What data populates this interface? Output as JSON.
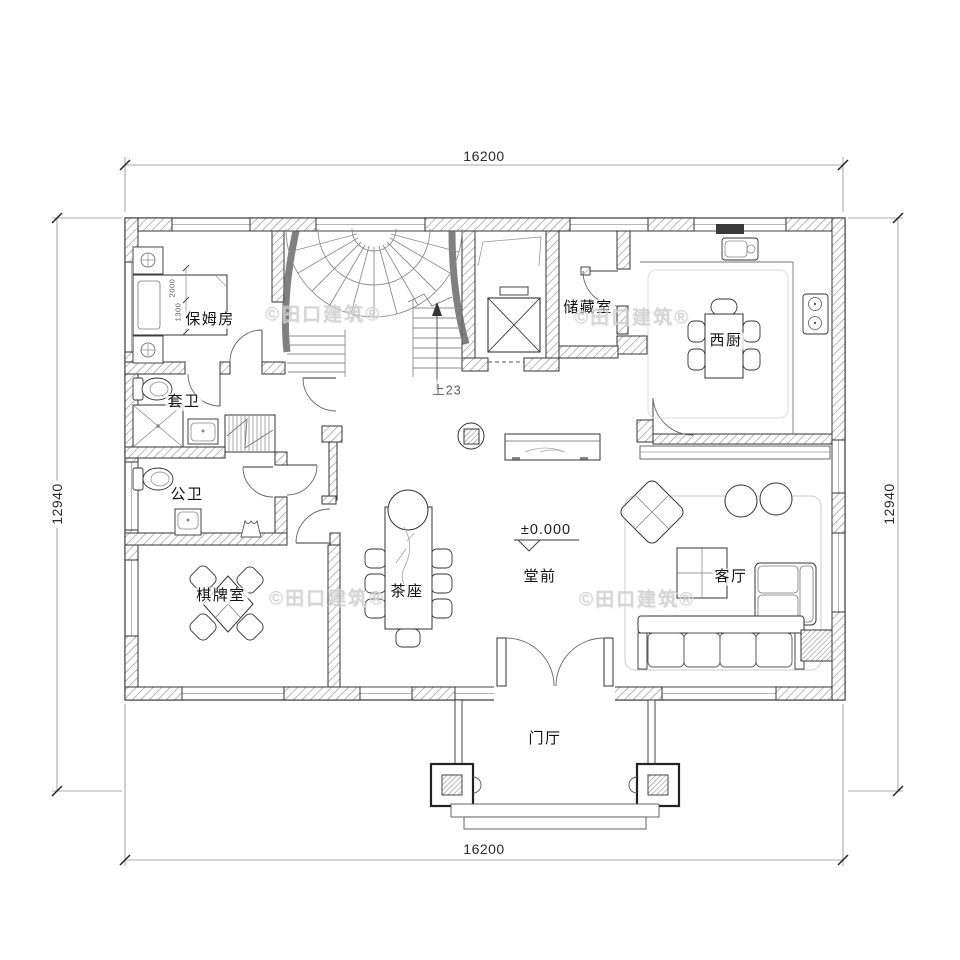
{
  "dims": {
    "top": "16200",
    "bottom": "16200",
    "left": "12940",
    "right": "12940"
  },
  "rooms": {
    "nanny": "保姆房",
    "ensuite": "套卫",
    "public_bath": "公卫",
    "chess": "棋牌室",
    "tea": "茶座",
    "front_hall": "堂前",
    "storage": "储藏室",
    "west_kitchen": "西厨",
    "living": "客厅",
    "foyer": "门厅"
  },
  "notes": {
    "elevation": "±0.000",
    "stair": "上23",
    "bed_w": "2000",
    "bed_d": "1300"
  },
  "watermark": "©田口建筑®",
  "colors": {
    "line": "#333333",
    "hatch": "#9a9a9a",
    "watermark": "#c9c9c9"
  }
}
